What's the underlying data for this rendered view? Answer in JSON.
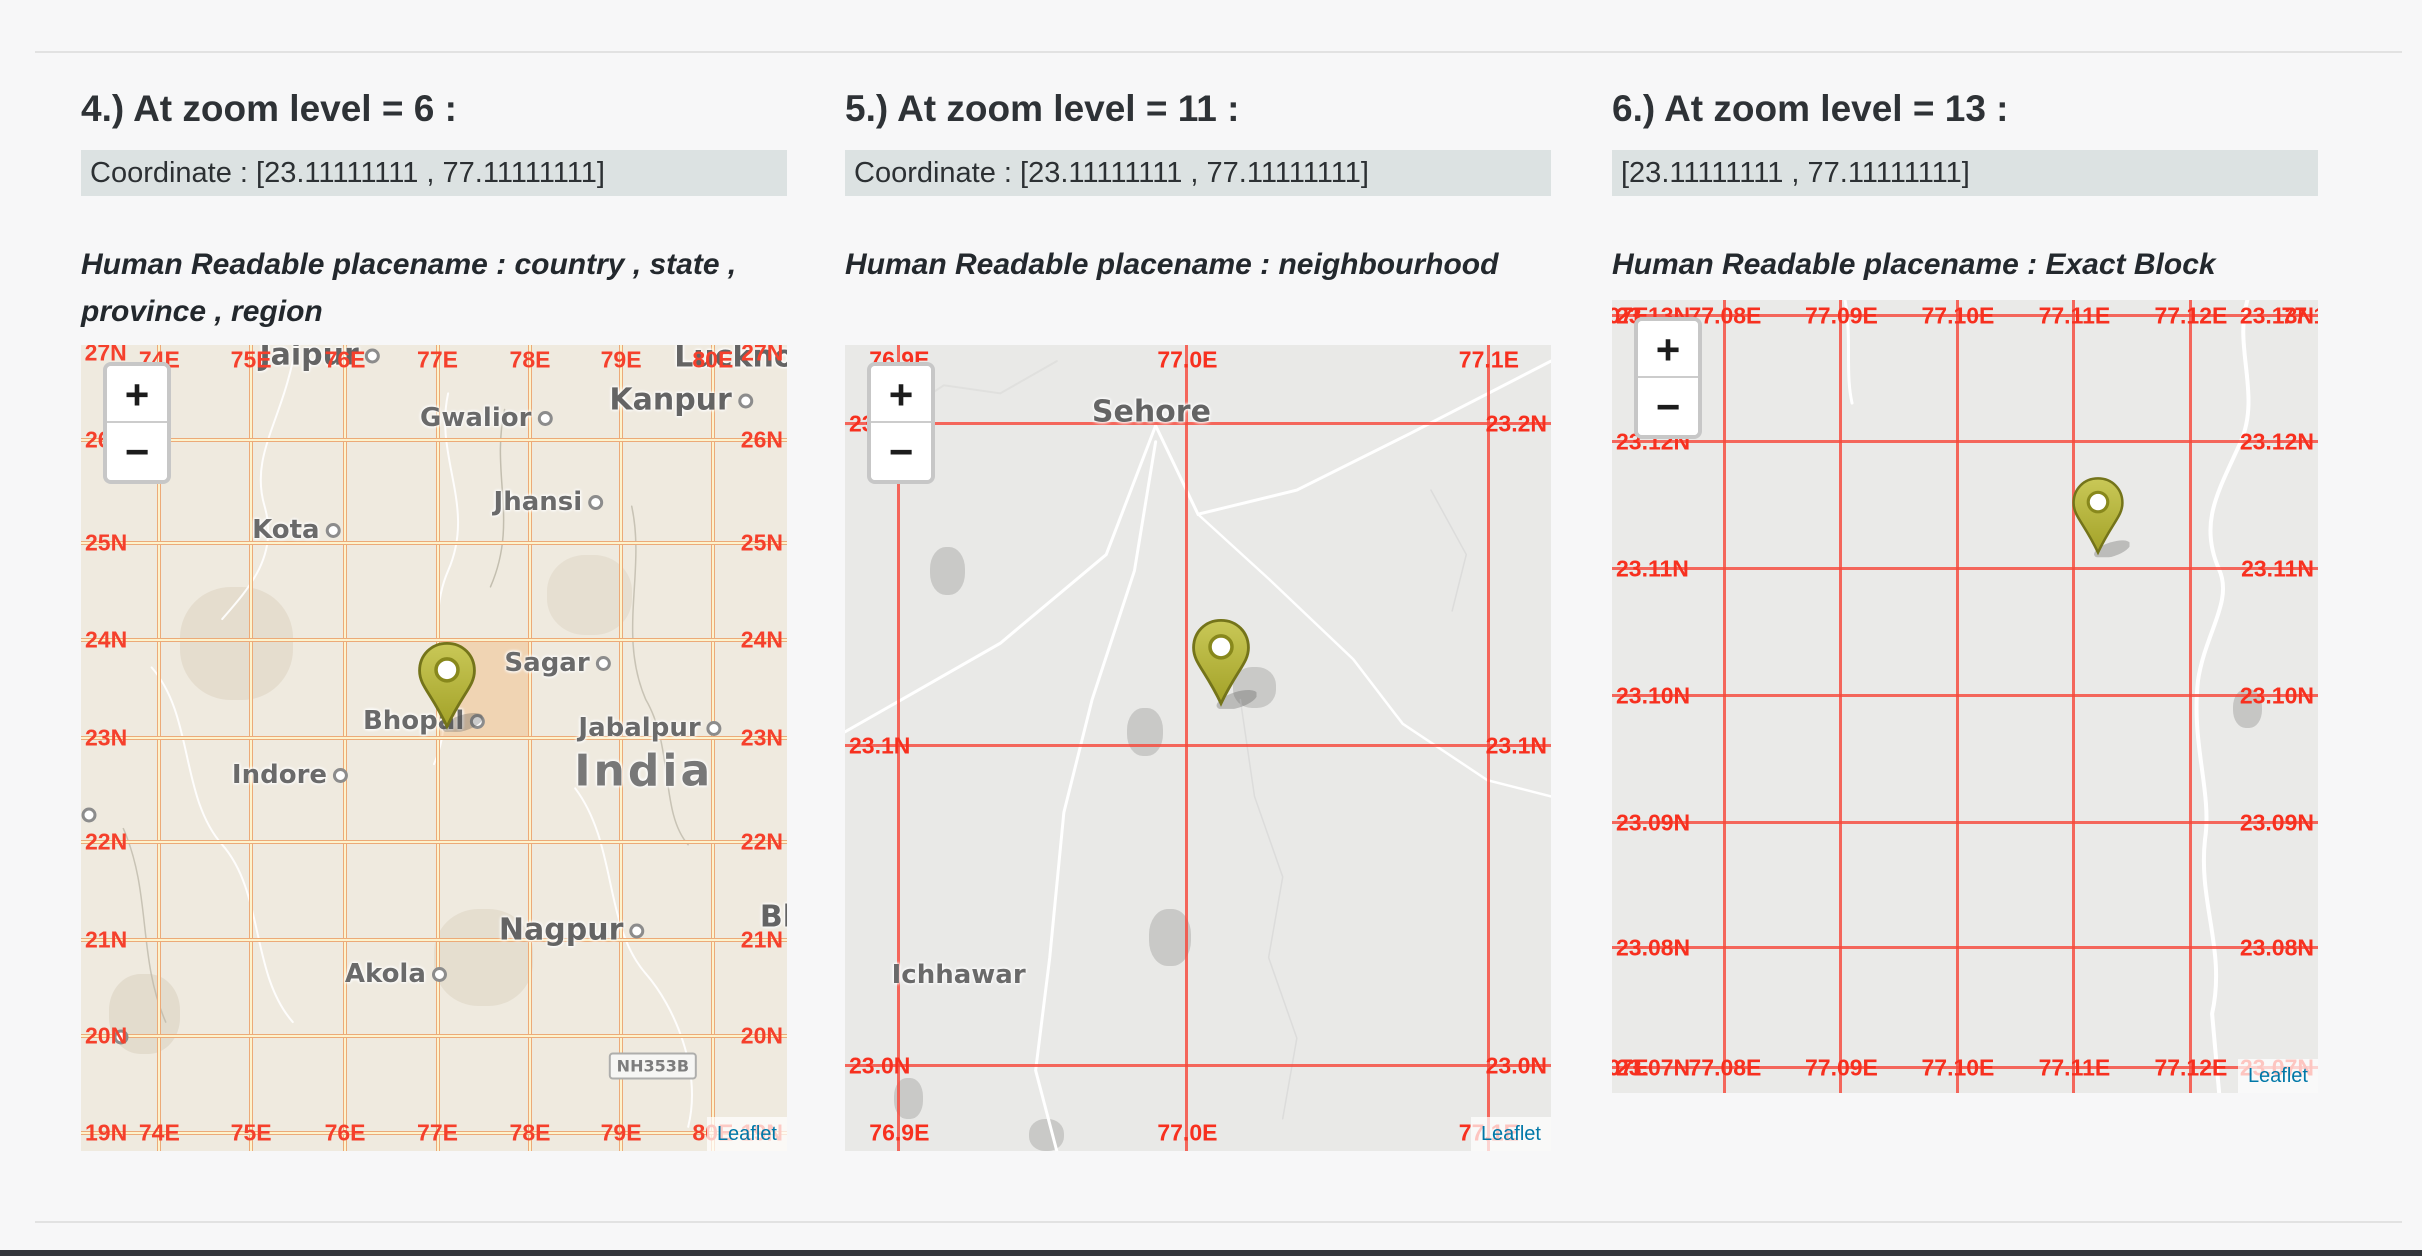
{
  "page": {
    "background": "#f7f7f8",
    "divider_color": "#e2e2e2",
    "bottom_bar_color": "#34373c",
    "attribution_link_color": "#0078A8"
  },
  "panels": [
    {
      "heading": "4.) At zoom level = 6 :",
      "coordinate": "Coordinate : [23.11111111 , 77.11111111]",
      "placename": "Human Readable placename : country , state , province , region",
      "map": {
        "bg": "#efeadf",
        "grid_style": "double",
        "grid_outer": "#ecaa78",
        "grid_inner": "#fdf3cd",
        "label_color": "#f5402c",
        "top_row_y": 1.8,
        "bottom_row_y": 97.8,
        "vlines": [
          {
            "t": "74E",
            "x": 11.1
          },
          {
            "t": "75E",
            "x": 24.1
          },
          {
            "t": "76E",
            "x": 37.4
          },
          {
            "t": "77E",
            "x": 50.5
          },
          {
            "t": "78E",
            "x": 63.6
          },
          {
            "t": "79E",
            "x": 76.5
          },
          {
            "t": "80E",
            "x": 89.5
          }
        ],
        "hlines": [
          {
            "t": "26N",
            "y": 11.8
          },
          {
            "t": "25N",
            "y": 24.6
          },
          {
            "t": "24N",
            "y": 36.6
          },
          {
            "t": "23N",
            "y": 48.8
          },
          {
            "t": "22N",
            "y": 61.7
          },
          {
            "t": "21N",
            "y": 73.8
          },
          {
            "t": "20N",
            "y": 85.7
          },
          {
            "t": "19N",
            "y": 97.8
          }
        ],
        "extra_labels": [
          {
            "t": "27N",
            "x": 3.5,
            "y": 1.0
          },
          {
            "t": "27N",
            "x": 96.5,
            "y": 1.0
          }
        ],
        "highlight": {
          "x1": 50.5,
          "x2": 63.6,
          "y1": 36.6,
          "y2": 48.8,
          "color": "rgba(243,166,88,0.32)"
        },
        "marker": {
          "x": 51.8,
          "y": 47.9,
          "h": 92
        },
        "cities": [
          {
            "t": "Jaipur",
            "x": 33.8,
            "y": 1.2,
            "cls": "major",
            "dot": true
          },
          {
            "t": "Gwalior",
            "x": 57.4,
            "y": 9.1,
            "cls": "city",
            "dot": true
          },
          {
            "t": "Kanpur",
            "x": 85.0,
            "y": 6.8,
            "cls": "major",
            "dot": true
          },
          {
            "t": "Lucknow",
            "x": 96.0,
            "y": 1.5,
            "cls": "major",
            "dot": true
          },
          {
            "t": "Jhansi",
            "x": 66.2,
            "y": 19.5,
            "cls": "city",
            "dot": true
          },
          {
            "t": "Kota",
            "x": 30.5,
            "y": 23.0,
            "cls": "city",
            "dot": true
          },
          {
            "t": "Sagar",
            "x": 67.5,
            "y": 39.4,
            "cls": "city",
            "dot": true
          },
          {
            "t": "Bhopal",
            "x": 48.6,
            "y": 46.7,
            "cls": "city",
            "dot": true
          },
          {
            "t": "Jabalpur",
            "x": 80.6,
            "y": 47.5,
            "cls": "city",
            "dot": true
          },
          {
            "t": "India",
            "x": 79.7,
            "y": 52.9,
            "cls": "country",
            "dot": false
          },
          {
            "t": "Indore",
            "x": 29.6,
            "y": 53.3,
            "cls": "city",
            "dot": true
          },
          {
            "t": "Nagpur",
            "x": 69.5,
            "y": 72.6,
            "cls": "major",
            "dot": true
          },
          {
            "t": "Akola",
            "x": 44.6,
            "y": 78.0,
            "cls": "city",
            "dot": true
          },
          {
            "t": "Bh",
            "x": 99.3,
            "y": 71.0,
            "cls": "major",
            "dot": false
          }
        ],
        "dots": [
          {
            "x": 1.1,
            "y": 58.3
          },
          {
            "x": 5.6,
            "y": 85.9
          }
        ],
        "shield": {
          "t": "NH353B",
          "x": 81.0,
          "y": 89.4
        },
        "roads": [
          {
            "d": "M30,2 C28,10 24,14 26,20 C28,26 24,30 20,34",
            "c": "rgba(255,255,255,0.9)",
            "w": 2
          },
          {
            "d": "M52,6 C50,14 56,20 52,28 C48,36 54,44 50,52",
            "c": "rgba(255,255,255,0.9)",
            "w": 2
          },
          {
            "d": "M10,40 C16,46 14,56 20,62 C26,68 24,78 30,84",
            "c": "rgba(255,255,255,0.9)",
            "w": 2
          },
          {
            "d": "M70,55 C76,62 74,72 80,78 C84,82 88,90 86,97",
            "c": "rgba(255,255,255,0.9)",
            "w": 2
          },
          {
            "d": "M60,8 C58,16 62,22 58,30",
            "c": "rgba(190,185,170,0.9)",
            "w": 1.5
          },
          {
            "d": "M78,20 C80,28 76,36 80,44 C84,50 82,58 86,62",
            "c": "rgba(190,185,170,0.8)",
            "w": 1.5
          },
          {
            "d": "M6,60 C10,68 8,76 12,84",
            "c": "rgba(190,185,170,0.8)",
            "w": 1.5
          }
        ],
        "blobs": [
          {
            "x": 14,
            "y": 30,
            "w": 16,
            "h": 14,
            "c": "rgba(220,210,192,0.55)"
          },
          {
            "x": 50,
            "y": 70,
            "w": 14,
            "h": 12,
            "c": "rgba(220,210,192,0.5)"
          },
          {
            "x": 4,
            "y": 78,
            "w": 10,
            "h": 10,
            "c": "rgba(215,205,188,0.5)"
          },
          {
            "x": 66,
            "y": 26,
            "w": 12,
            "h": 10,
            "c": "rgba(222,212,196,0.5)"
          }
        ],
        "zoom": {
          "in": "+",
          "out": "−"
        },
        "attribution": "Leaflet"
      }
    },
    {
      "heading": "5.) At zoom level = 11 :",
      "coordinate": "Coordinate : [23.11111111 , 77.11111111]",
      "placename": "Human Readable placename : neighbourhood",
      "map": {
        "bg": "#e9e9e7",
        "grid_style": "solid",
        "grid_color": "rgba(247,73,60,0.82)",
        "label_color": "#f7301f",
        "top_row_y": 1.8,
        "bottom_row_y": 97.8,
        "vlines": [
          {
            "t": "76.9E",
            "x": 7.7
          },
          {
            "t": "77.0E",
            "x": 48.5
          },
          {
            "t": "77.1E",
            "x": 91.2
          }
        ],
        "hlines": [
          {
            "t": "23.2N",
            "y": 9.8
          },
          {
            "t": "23.1N",
            "y": 49.8
          },
          {
            "t": "23.0N",
            "y": 89.4
          }
        ],
        "extra_labels": [],
        "highlight": null,
        "marker": {
          "x": 53.2,
          "y": 45.0,
          "h": 92
        },
        "cities": [
          {
            "t": "Sehore",
            "x": 43.4,
            "y": 8.3,
            "cls": "major",
            "dot": false
          },
          {
            "t": "Ichhawar",
            "x": 16.1,
            "y": 78.2,
            "cls": "city",
            "dot": false
          }
        ],
        "dots": [],
        "shield": null,
        "roads": [
          {
            "d": "M100,2 L80,11 L64,18 L50,21 L44,10",
            "c": "#ffffff",
            "w": 3
          },
          {
            "d": "M44,10 L37,26 L22,37 L8,44 L0,48",
            "c": "#ffffff",
            "w": 3
          },
          {
            "d": "M44,12 L41,28 L35,44 L31,58 L29,76 L27,90 L30,100",
            "c": "#ffffff",
            "w": 3
          },
          {
            "d": "M50,21 L60,29 L72,39 L79,47 L91,54 L100,56",
            "c": "#ffffff",
            "w": 2.5
          },
          {
            "d": "M30,2 L22,6 L14,5 L7,9 L0,10",
            "c": "#e0e0de",
            "w": 2
          },
          {
            "d": "M56,44 L58,56 L62,66 L60,76 L64,86 L62,96",
            "c": "#dcdcdb",
            "w": 1.5
          },
          {
            "d": "M83,18 L88,26 L86,33",
            "c": "#dcdcdb",
            "w": 1.5
          }
        ],
        "blobs": [
          {
            "x": 40,
            "y": 45,
            "w": 5,
            "h": 6,
            "c": "#c9c9c7"
          },
          {
            "x": 55,
            "y": 40,
            "w": 6,
            "h": 5,
            "c": "#c9c9c7"
          },
          {
            "x": 43,
            "y": 70,
            "w": 6,
            "h": 7,
            "c": "#c9c9c7"
          },
          {
            "x": 12,
            "y": 25,
            "w": 5,
            "h": 6,
            "c": "#c9c9c7"
          },
          {
            "x": 7,
            "y": 91,
            "w": 4,
            "h": 5,
            "c": "#c9c9c7"
          },
          {
            "x": 26,
            "y": 96,
            "w": 5,
            "h": 4,
            "c": "#c9c9c7"
          }
        ],
        "zoom": {
          "in": "+",
          "out": "−"
        },
        "attribution": "Leaflet"
      }
    },
    {
      "heading": "6.) At zoom level = 13 :",
      "coordinate": "[23.11111111 , 77.11111111]",
      "placename": "Human Readable placename : Exact Block",
      "map": {
        "bg": "#eaeae8",
        "grid_style": "solid",
        "grid_color": "rgba(247,73,60,0.82)",
        "label_color": "#f7301f",
        "top_row_y": 2.0,
        "bottom_row_y": 96.9,
        "vlines": [
          {
            "t": "77.08E",
            "x": 16.0
          },
          {
            "t": "77.09E",
            "x": 32.5
          },
          {
            "t": "77.10E",
            "x": 49.0
          },
          {
            "t": "77.11E",
            "x": 65.5
          },
          {
            "t": "77.12E",
            "x": 82.0
          }
        ],
        "hlines": [
          {
            "t": "23.13N",
            "y": 2.0
          },
          {
            "t": "23.12N",
            "y": 17.9
          },
          {
            "t": "23.11N",
            "y": 33.9
          },
          {
            "t": "23.10N",
            "y": 49.9
          },
          {
            "t": "23.09N",
            "y": 65.9
          },
          {
            "t": "23.08N",
            "y": 81.7
          },
          {
            "t": "23.07N",
            "y": 96.9
          }
        ],
        "extra_labels": [
          {
            "t": "77.07E",
            "x": 0,
            "y": 2.0
          },
          {
            "t": "77.13E",
            "x": 100,
            "y": 2.0
          },
          {
            "t": "77.07E",
            "x": 0,
            "y": 96.9
          }
        ],
        "highlight": null,
        "marker": {
          "x": 68.9,
          "y": 32.4,
          "h": 82
        },
        "cities": [],
        "dots": [],
        "shield": null,
        "roads": [
          {
            "d": "M90,0 C88,6 92,12 89,18 C86,24 83,28 86,34 C88,38 84,42 83,48 C82,56 85,62 84,68 C83,76 87,82 85,90 L86,100",
            "c": "#ffffff",
            "w": 4
          },
          {
            "d": "M33,0 C34,5 33,9 34,13",
            "c": "#ffffff",
            "w": 3
          }
        ],
        "blobs": [
          {
            "x": 88,
            "y": 49,
            "w": 4,
            "h": 5,
            "c": "#c6c6c4"
          }
        ],
        "zoom": {
          "in": "+",
          "out": "−"
        },
        "attribution": "Leaflet"
      }
    }
  ]
}
